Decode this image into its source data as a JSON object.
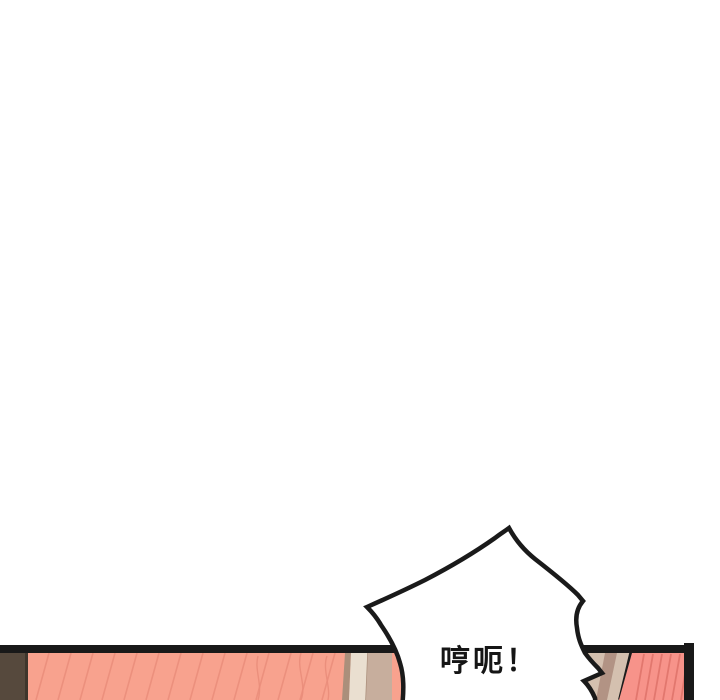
{
  "page": {
    "background_color": "#ffffff"
  },
  "panel": {
    "border_color": "#191919",
    "wall_strip_color": "#56493d",
    "wall_strip_edge_color": "#3e362c",
    "skin_left_color": "#f8a28e",
    "skin_left_stripe_color": "#ea8d7b",
    "skin_right_color": "#f7938a",
    "skin_right_stripe_color": "#e0756b",
    "cream_strip_color": "#eadfd0",
    "tan_light_color": "#d4c0af",
    "tan_mid_color": "#c7ae9d",
    "tan_dark_color": "#b29384",
    "tan_edge_color": "#ab8f7b"
  },
  "speech_bubble": {
    "text": "哼呃！",
    "fill_color": "#ffffff",
    "outline_color": "#1a1a1a",
    "text_color": "#151515"
  }
}
